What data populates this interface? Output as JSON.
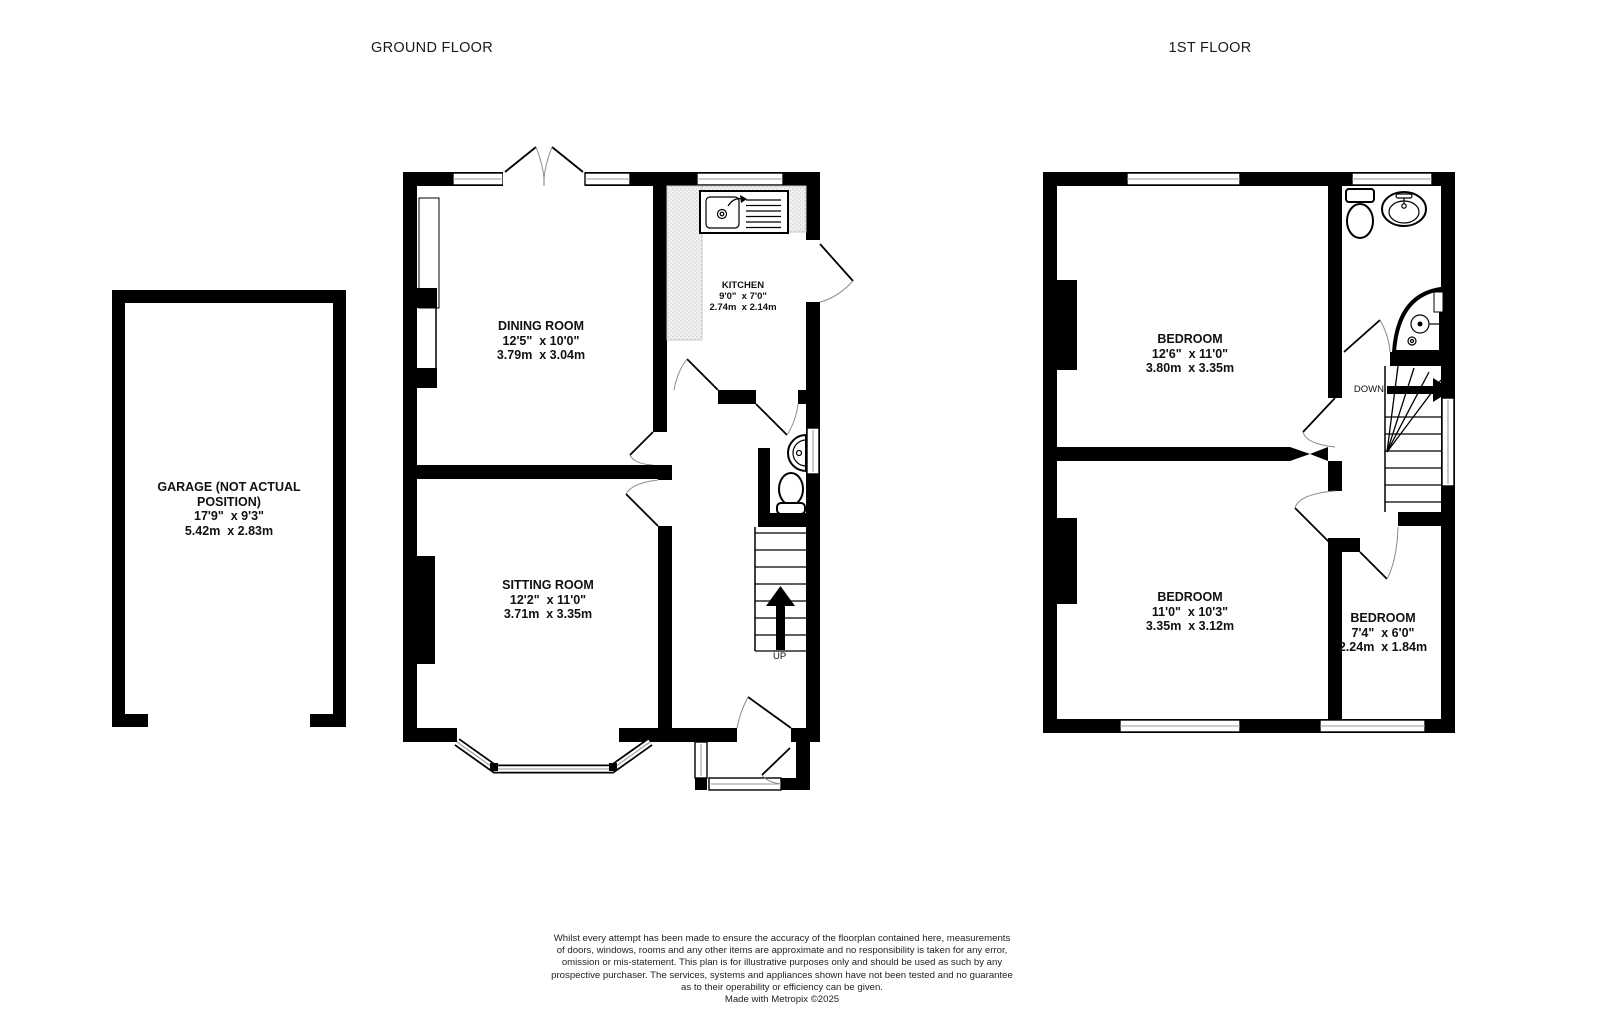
{
  "titles": {
    "ground_floor": "GROUND FLOOR",
    "first_floor": "1ST FLOOR"
  },
  "rooms": {
    "garage": {
      "name": "GARAGE (NOT ACTUAL POSITION)",
      "imperial": "17'9\"  x 9'3\"",
      "metric": "5.42m  x 2.83m"
    },
    "dining_room": {
      "name": "DINING ROOM",
      "imperial": "12'5\"  x 10'0\"",
      "metric": "3.79m  x 3.04m"
    },
    "kitchen": {
      "name": "KITCHEN",
      "imperial": "9'0\"  x 7'0\"",
      "metric": "2.74m  x 2.14m"
    },
    "sitting_room": {
      "name": "SITTING ROOM",
      "imperial": "12'2\"  x 11'0\"",
      "metric": "3.71m  x 3.35m"
    },
    "bedroom_1": {
      "name": "BEDROOM",
      "imperial": "12'6\"  x 11'0\"",
      "metric": "3.80m  x 3.35m"
    },
    "bedroom_2": {
      "name": "BEDROOM",
      "imperial": "11'0\"  x 10'3\"",
      "metric": "3.35m  x 3.12m"
    },
    "bedroom_3": {
      "name": "BEDROOM",
      "imperial": "7'4\"  x 6'0\"",
      "metric": "2.24m  x 1.84m"
    }
  },
  "stairs": {
    "ground_floor_direction": "UP",
    "first_floor_direction": "DOWN"
  },
  "colors": {
    "wall": "#000000",
    "background": "#ffffff",
    "window_line": "#9a9a9a",
    "counter": "#e9e9e9"
  },
  "footer": {
    "lines": [
      "Whilst every attempt has been made to ensure the accuracy of the floorplan contained here, measurements",
      "of doors, windows, rooms and any other items are approximate and no responsibility is taken for any error,",
      "omission or mis-statement. This plan is for illustrative purposes only and should be used as such by any",
      "prospective purchaser. The services, systems and appliances shown have not been tested and no guarantee",
      "as to their operability or efficiency can be given.",
      "Made with Metropix ©2025"
    ]
  }
}
